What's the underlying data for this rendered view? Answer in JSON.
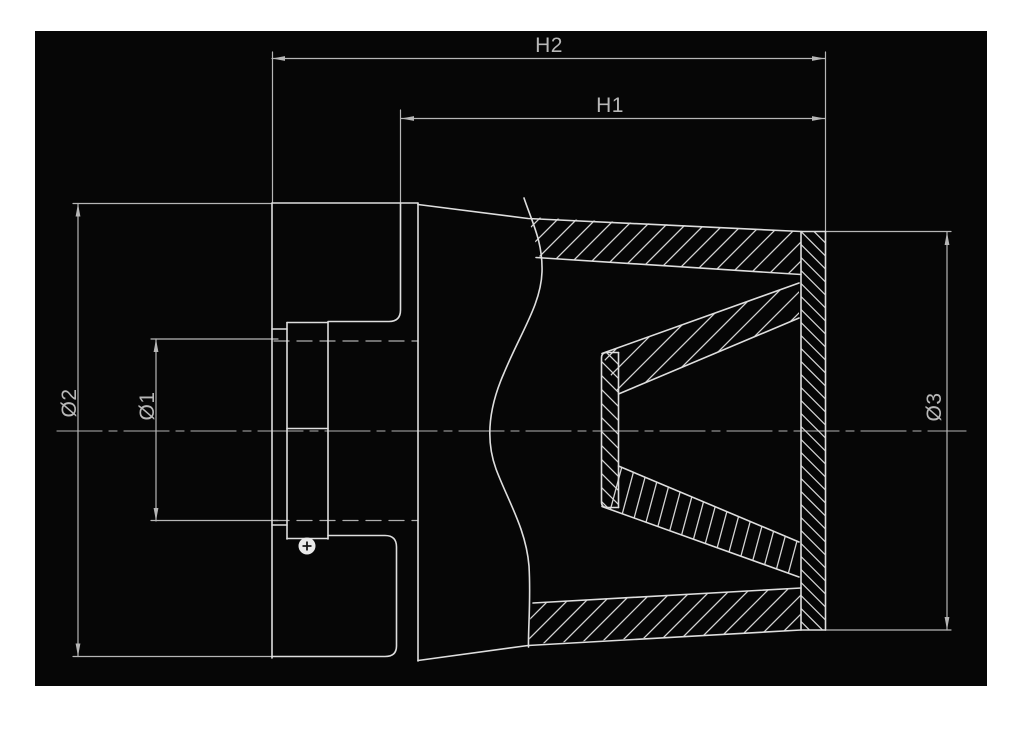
{
  "diagram": {
    "type": "technical-drawing",
    "subject": "cone-air-filter-sectional-view",
    "canvas": {
      "width": 1024,
      "height": 736,
      "page_bg": "#ffffff",
      "drawing_bg": "#060606",
      "board": {
        "x": 35,
        "y": 31,
        "w": 952,
        "h": 655
      }
    },
    "colors": {
      "outline": "#dedede",
      "dim": "#b6b6b6",
      "hatch": "#d4d4d4",
      "center": "#8f8f8f",
      "hidden": "#aeaeae",
      "text": "#b8b8b8",
      "marker_fill": "#e9e9e9",
      "marker_cross": "#161616"
    },
    "labels": [
      {
        "id": "h2",
        "text": "H2",
        "x": 549,
        "y": 52,
        "rotate": 0
      },
      {
        "id": "h1",
        "text": "H1",
        "x": 610,
        "y": 112,
        "rotate": 0
      },
      {
        "id": "d2",
        "text": "Ø2",
        "x": 76,
        "y": 403,
        "rotate": -90
      },
      {
        "id": "d1",
        "text": "Ø1",
        "x": 154,
        "y": 406,
        "rotate": -90
      },
      {
        "id": "d3",
        "text": "Ø3",
        "x": 941,
        "y": 407,
        "rotate": -90
      }
    ],
    "outline_paths": [
      {
        "name": "flange-left-edge",
        "d": "M272,203 L272,658"
      },
      {
        "name": "flange-top-edge",
        "d": "M272,203 L418,203"
      },
      {
        "name": "flange-right-face",
        "d": "M418,203 L418,661"
      },
      {
        "name": "flange-pocket-top",
        "d": "M400.5,203 L400.5,310 Q400.5,321.5 389,321.5 L328,321.5"
      },
      {
        "name": "flange-pocket-bottom",
        "d": "M328,535.5 L385,535.5 Q396.5,535.5 396.5,547 L396.5,646 Q396.5,656.5 385,656.5 L272,656.5"
      },
      {
        "name": "neck-left-edge",
        "d": "M287,322.5 L287,539"
      },
      {
        "name": "neck-right-edge",
        "d": "M328,322.5 L328,539"
      },
      {
        "name": "neck-top-edge",
        "d": "M287,322.5 L328,322.5"
      },
      {
        "name": "neck-bottom-edge",
        "d": "M287,538.5 L328,538.5"
      },
      {
        "name": "neck-mid-line",
        "d": "M287,428.5 L328,428.5"
      },
      {
        "name": "flange-step-top",
        "d": "M272,329 L287,329"
      },
      {
        "name": "flange-step-bottom",
        "d": "M272,525 L287,525"
      },
      {
        "name": "cone-top-outer-edge",
        "d": "M418,204.5 L528,218.5 L801,231.5"
      },
      {
        "name": "cone-bottom-outer-edge",
        "d": "M418,660.5 L528,645.5 L801,630"
      },
      {
        "name": "cone-top-inner-edge",
        "d": "M536,257.5 L801,274.5"
      },
      {
        "name": "cone-bottom-inner-edge",
        "d": "M533,603 L801,588"
      },
      {
        "name": "end-cap-left-edge",
        "d": "M801,231.5 L801,630"
      },
      {
        "name": "end-cap-right-edge",
        "d": "M825.5,231.5 L825.5,630"
      },
      {
        "name": "end-cap-top-edge",
        "d": "M801,231.5 L825.5,231.5"
      },
      {
        "name": "end-cap-bottom-edge",
        "d": "M801,630 L825.5,630"
      },
      {
        "name": "inner-cone-top-upper",
        "d": "M602,353.5 L799,283"
      },
      {
        "name": "inner-cone-top-lower",
        "d": "M618.5,394 L799,318"
      },
      {
        "name": "inner-cone-bottom-upper",
        "d": "M618.5,466 L799,542"
      },
      {
        "name": "inner-cone-bottom-lower",
        "d": "M602,506.5 L799,577"
      },
      {
        "name": "inner-tube-outline",
        "d": "M618.5,352.5 L607,352.5 Q601.5,352.5 601.5,358 L601.5,502 Q601.5,507.5 607,507.5 L618.5,507.5"
      },
      {
        "name": "inner-tube-right-edge",
        "d": "M618.5,352.5 L618.5,507.5"
      },
      {
        "name": "section-break-wavy-line",
        "d": "M524,198 C532,222 543,242 542,272 C541,304 521,332 504,373 C489,407 485,439 496,469 C508,501 526,529 529,566 C531,600 528,630 528.5,647"
      }
    ],
    "dim_lines": [
      {
        "name": "dim-line-h2",
        "d": "M272,58.5 L825,58.5"
      },
      {
        "name": "dim-line-h1",
        "d": "M401,118.5 L825,118.5"
      },
      {
        "name": "ext-line-h2-left",
        "d": "M272.5,52 L272.5,203"
      },
      {
        "name": "ext-line-right",
        "d": "M825.5,52 L825.5,231.5"
      },
      {
        "name": "ext-line-h1-left",
        "d": "M400.5,110 L400.5,203"
      },
      {
        "name": "dim-line-d2",
        "d": "M78,203.5 L78,656.5"
      },
      {
        "name": "ext-line-d2-top",
        "d": "M73,203.5 L272,203.5"
      },
      {
        "name": "ext-line-d2-bottom",
        "d": "M73,656.5 L272,656.5"
      },
      {
        "name": "dim-line-d1",
        "d": "M156,339 L156,521"
      },
      {
        "name": "ext-line-d1-top",
        "d": "M151,339 L278,339"
      },
      {
        "name": "ext-line-d1-bottom",
        "d": "M151,520.5 L278,520.5"
      },
      {
        "name": "dim-line-d3",
        "d": "M947,232 L947,630"
      },
      {
        "name": "ext-line-d3-top",
        "d": "M825.5,231.5 L951,231.5"
      },
      {
        "name": "ext-line-d3-bottom",
        "d": "M825.5,630 L951,630"
      }
    ],
    "hidden_lines": [
      {
        "name": "hidden-bore-top",
        "d": "M274,341 L418,341"
      },
      {
        "name": "hidden-bore-bottom",
        "d": "M274,520.5 L418,520.5"
      }
    ],
    "centerline": {
      "name": "center-axis-line",
      "d": "M57,431 L966,431",
      "dash": "45 7 8 7"
    },
    "arrows": [
      {
        "x": 272,
        "y": 58.5,
        "dir": "left"
      },
      {
        "x": 825,
        "y": 58.5,
        "dir": "right"
      },
      {
        "x": 401,
        "y": 118.5,
        "dir": "left"
      },
      {
        "x": 825,
        "y": 118.5,
        "dir": "right"
      },
      {
        "x": 78,
        "y": 203.5,
        "dir": "up"
      },
      {
        "x": 78,
        "y": 656.5,
        "dir": "down"
      },
      {
        "x": 156,
        "y": 339,
        "dir": "up"
      },
      {
        "x": 156,
        "y": 521,
        "dir": "down"
      },
      {
        "x": 947,
        "y": 232,
        "dir": "up"
      },
      {
        "x": 947,
        "y": 630,
        "dir": "down"
      }
    ],
    "hatches": [
      {
        "name": "hatch-top-outer-wall",
        "points": [
          [
            528,
            217
          ],
          [
            801,
            231.5
          ],
          [
            801,
            274.5
          ],
          [
            540,
            258
          ]
        ],
        "angle": 45,
        "spacing": 19
      },
      {
        "name": "hatch-bottom-outer-wall",
        "points": [
          [
            531,
            603
          ],
          [
            801,
            588
          ],
          [
            801,
            630
          ],
          [
            529,
            644
          ]
        ],
        "angle": 45,
        "spacing": 19
      },
      {
        "name": "hatch-end-cap",
        "points": [
          [
            801,
            231.5
          ],
          [
            825.5,
            231.5
          ],
          [
            825.5,
            630
          ],
          [
            801,
            630
          ]
        ],
        "angle": 135,
        "spacing": 13
      },
      {
        "name": "hatch-inner-cone-top",
        "points": [
          [
            602,
            353.5
          ],
          [
            799,
            283
          ],
          [
            799,
            318
          ],
          [
            618.5,
            394
          ]
        ],
        "angle": 45,
        "spacing": 21
      },
      {
        "name": "hatch-inner-cone-bottom",
        "points": [
          [
            618.5,
            466
          ],
          [
            799,
            542
          ],
          [
            799,
            577
          ],
          [
            602,
            506.5
          ]
        ],
        "angle": 75,
        "spacing": 13
      },
      {
        "name": "hatch-inner-tube-end",
        "points": [
          [
            601.5,
            352.5
          ],
          [
            618.5,
            352.5
          ],
          [
            618.5,
            507.5
          ],
          [
            601.5,
            507.5
          ]
        ],
        "angle": 135,
        "spacing": 14
      }
    ],
    "marker": {
      "name": "vent-hole-marker",
      "cx": 307,
      "cy": 546,
      "r": 8.5
    }
  }
}
